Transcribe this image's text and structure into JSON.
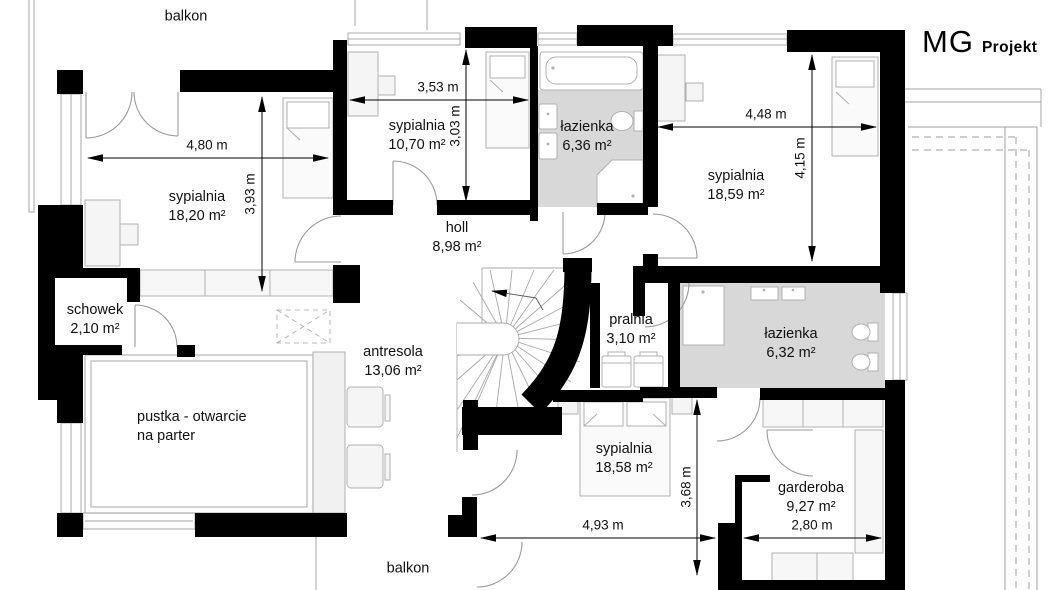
{
  "brand": {
    "mg": "MG",
    "projekt": "Projekt"
  },
  "rooms": {
    "balkon_top": {
      "name": "balkon"
    },
    "sypialnia_1": {
      "name": "sypialnia",
      "area": "18,20 m²"
    },
    "sypialnia_2": {
      "name": "sypialnia",
      "area": "10,70 m²"
    },
    "lazienka_1": {
      "name": "łazienka",
      "area": "6,36 m²"
    },
    "sypialnia_3": {
      "name": "sypialnia",
      "area": "18,59 m²"
    },
    "holl": {
      "name": "holl",
      "area": "8,98 m²"
    },
    "schowek": {
      "name": "schowek",
      "area": "2,10 m²"
    },
    "antresola": {
      "name": "antresola",
      "area": "13,06 m²"
    },
    "pustka": {
      "line1": "pustka  - otwarcie",
      "line2": "na parter"
    },
    "pralnia": {
      "name": "pralnia",
      "area": "3,10 m²"
    },
    "lazienka_2": {
      "name": "łazienka",
      "area": "6,32 m²"
    },
    "sypialnia_4": {
      "name": "sypialnia",
      "area": "18,58 m²"
    },
    "garderoba": {
      "name": "garderoba",
      "area": "9,27 m²"
    },
    "balkon_bottom": {
      "name": "balkon"
    }
  },
  "dimensions": {
    "d480": "4,80 m",
    "d393": "3,93 m",
    "d353": "3,53 m",
    "d303": "3,03 m",
    "d448": "4,48 m",
    "d415": "4,15 m",
    "d493": "4,93 m",
    "d368": "3,68 m",
    "d280": "2,80 m"
  },
  "colors": {
    "wall": "#000000",
    "bathroom_fill": "#d8d8d8",
    "furniture_fill": "#f4f4f4",
    "outline": "#9a9a9a",
    "text": "#111111"
  }
}
